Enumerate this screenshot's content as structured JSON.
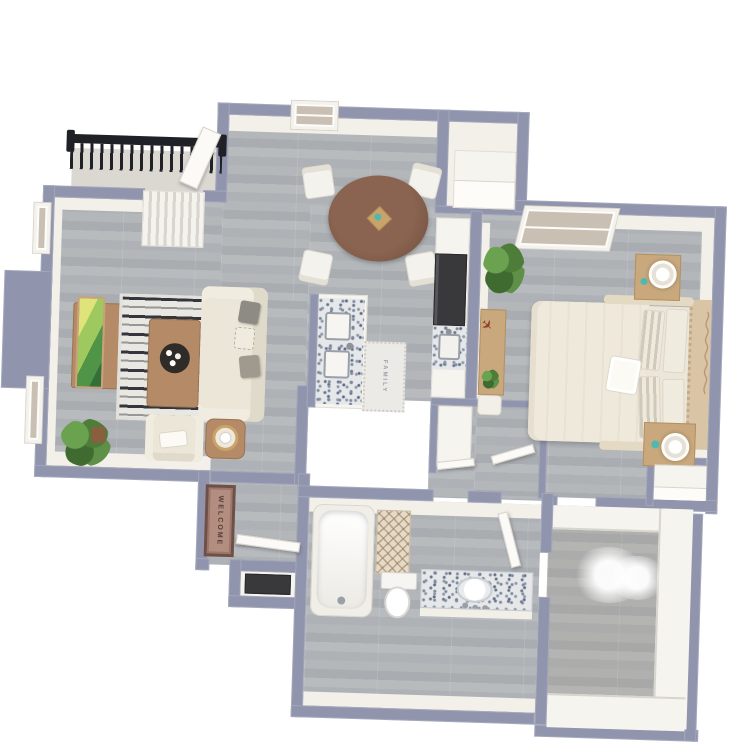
{
  "scene": {
    "type": "3d-rendered-apartment-floor-plan",
    "background": "#ffffff",
    "view": "top-down dollhouse render, slightly rotated clockwise"
  },
  "texts": {
    "doormat": "WELCOME",
    "kitchen_runner": "FAMILY"
  },
  "palette": {
    "wall_cap": "#9095ad",
    "wall_face_white": "#f3f0e9",
    "floor_plank_light": "#b7bbbe",
    "floor_plank_dark": "#a9adb1",
    "balcony_floor": "#dbd8d2",
    "railing_black": "#202126",
    "wood_light": "#c8a87c",
    "wood_medium": "#b48b66",
    "dining_table_brown": "#7b5a49",
    "upholstery_cream": "#ebe6d8",
    "pillow_gray": "#8e8b84",
    "rug_dark": "#35353d",
    "rug_light": "#e9e7e1",
    "granite_base": "#e6e7e9",
    "granite_speckle": "#7c8aa0",
    "appliance_dark": "#39393c",
    "plant_green": "#56893f",
    "accent_teal": "#4fb8b0",
    "doormat_brown": "#b38d80",
    "tv_art_green": "#4f9447",
    "tv_art_yellow": "#e0e379"
  },
  "rooms": [
    {
      "name": "balcony",
      "furniture": [
        "iron-railing",
        "open-door"
      ]
    },
    {
      "name": "living-room",
      "furniture": [
        "tv-console",
        "tv",
        "area-rug",
        "coffee-table",
        "sofa",
        "armchair",
        "side-table",
        "floor-plant",
        "windows"
      ]
    },
    {
      "name": "dining-area",
      "furniture": [
        "round-table",
        "four-chairs",
        "window",
        "centerpiece"
      ]
    },
    {
      "name": "kitchen",
      "furniture": [
        "island-with-sink",
        "granite-counter",
        "refrigerator",
        "runner-rug"
      ]
    },
    {
      "name": "laundry-closet",
      "furniture": [
        "stacked-appliance"
      ]
    },
    {
      "name": "entry",
      "furniture": [
        "welcome-mat",
        "front-door",
        "entry-closet-dark-mat"
      ]
    },
    {
      "name": "bedroom",
      "furniture": [
        "bed",
        "headboard",
        "pillows",
        "nightstand-1",
        "lamp-1",
        "nightstand-2",
        "lamp-2",
        "desk",
        "airplane-decor",
        "corner-plant",
        "window",
        "wall-script-decal",
        "reach-in-closet"
      ]
    },
    {
      "name": "hallway",
      "furniture": [
        "linen-closet",
        "open-doors"
      ]
    },
    {
      "name": "bathroom",
      "furniture": [
        "bathtub",
        "toilet",
        "granite-vanity",
        "sink",
        "shower-curtain",
        "door"
      ]
    },
    {
      "name": "walk-in-closet",
      "furniture": [
        "shelving"
      ]
    }
  ]
}
